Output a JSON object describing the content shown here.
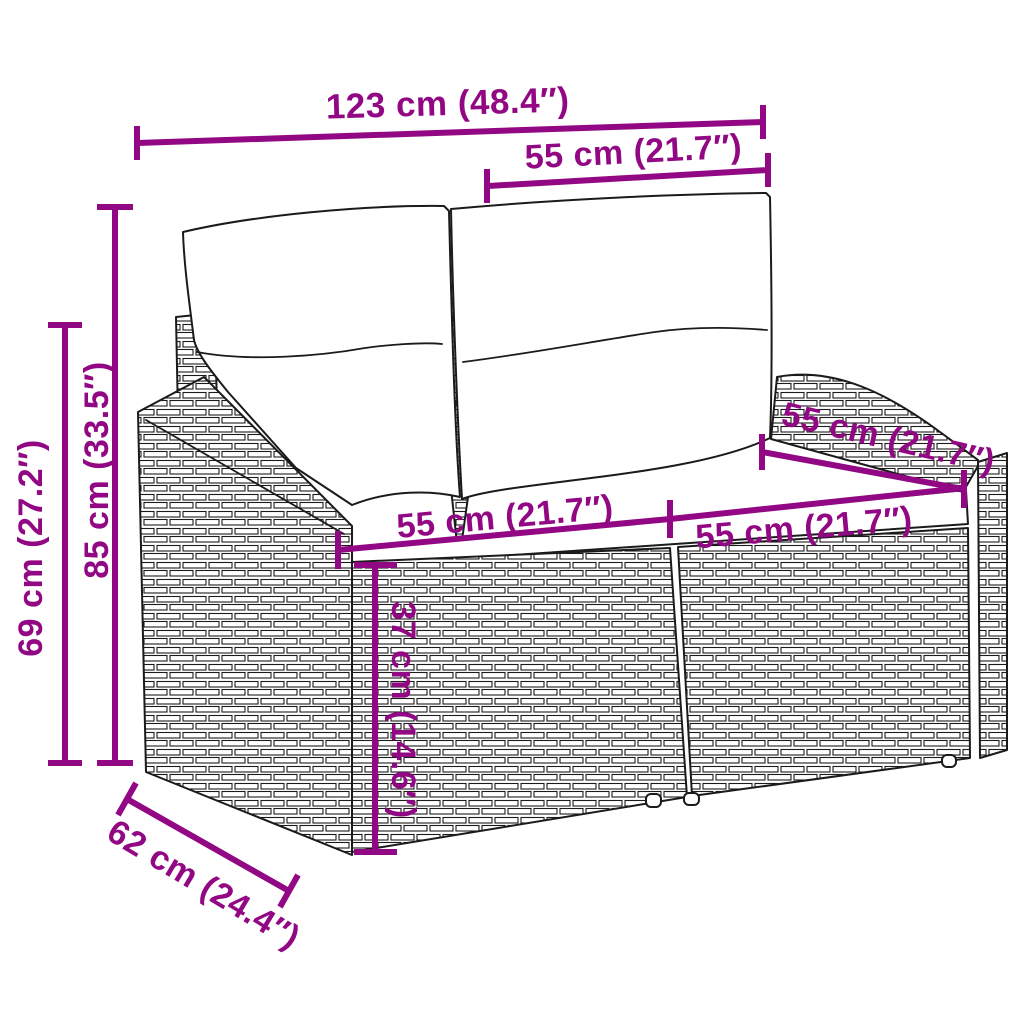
{
  "diagram": {
    "type": "product-dimension-diagram",
    "product": "poly rattan 2-seater garden sofa with back and seat cushions",
    "style": "black line art with woven rattan texture, white background",
    "colors": {
      "annotation": "#920783",
      "line_art": "#1b1b1b",
      "background": "#ffffff"
    }
  },
  "dims": [
    {
      "id": "overall-width",
      "label": "123 cm (48.4″)"
    },
    {
      "id": "backrest-width",
      "label": "55 cm (21.7″)"
    },
    {
      "id": "overall-height",
      "label": "85 cm (33.5″)"
    },
    {
      "id": "arm-height",
      "label": "69 cm (27.2″)"
    },
    {
      "id": "seat-depth",
      "label": "55 cm (21.7″)"
    },
    {
      "id": "seat-width-left",
      "label": "55 cm (21.7″)"
    },
    {
      "id": "seat-width-right",
      "label": "55 cm (21.7″)"
    },
    {
      "id": "seat-height",
      "label": "37 cm (14.6″)"
    },
    {
      "id": "overall-depth",
      "label": "62 cm (24.4″)"
    }
  ]
}
